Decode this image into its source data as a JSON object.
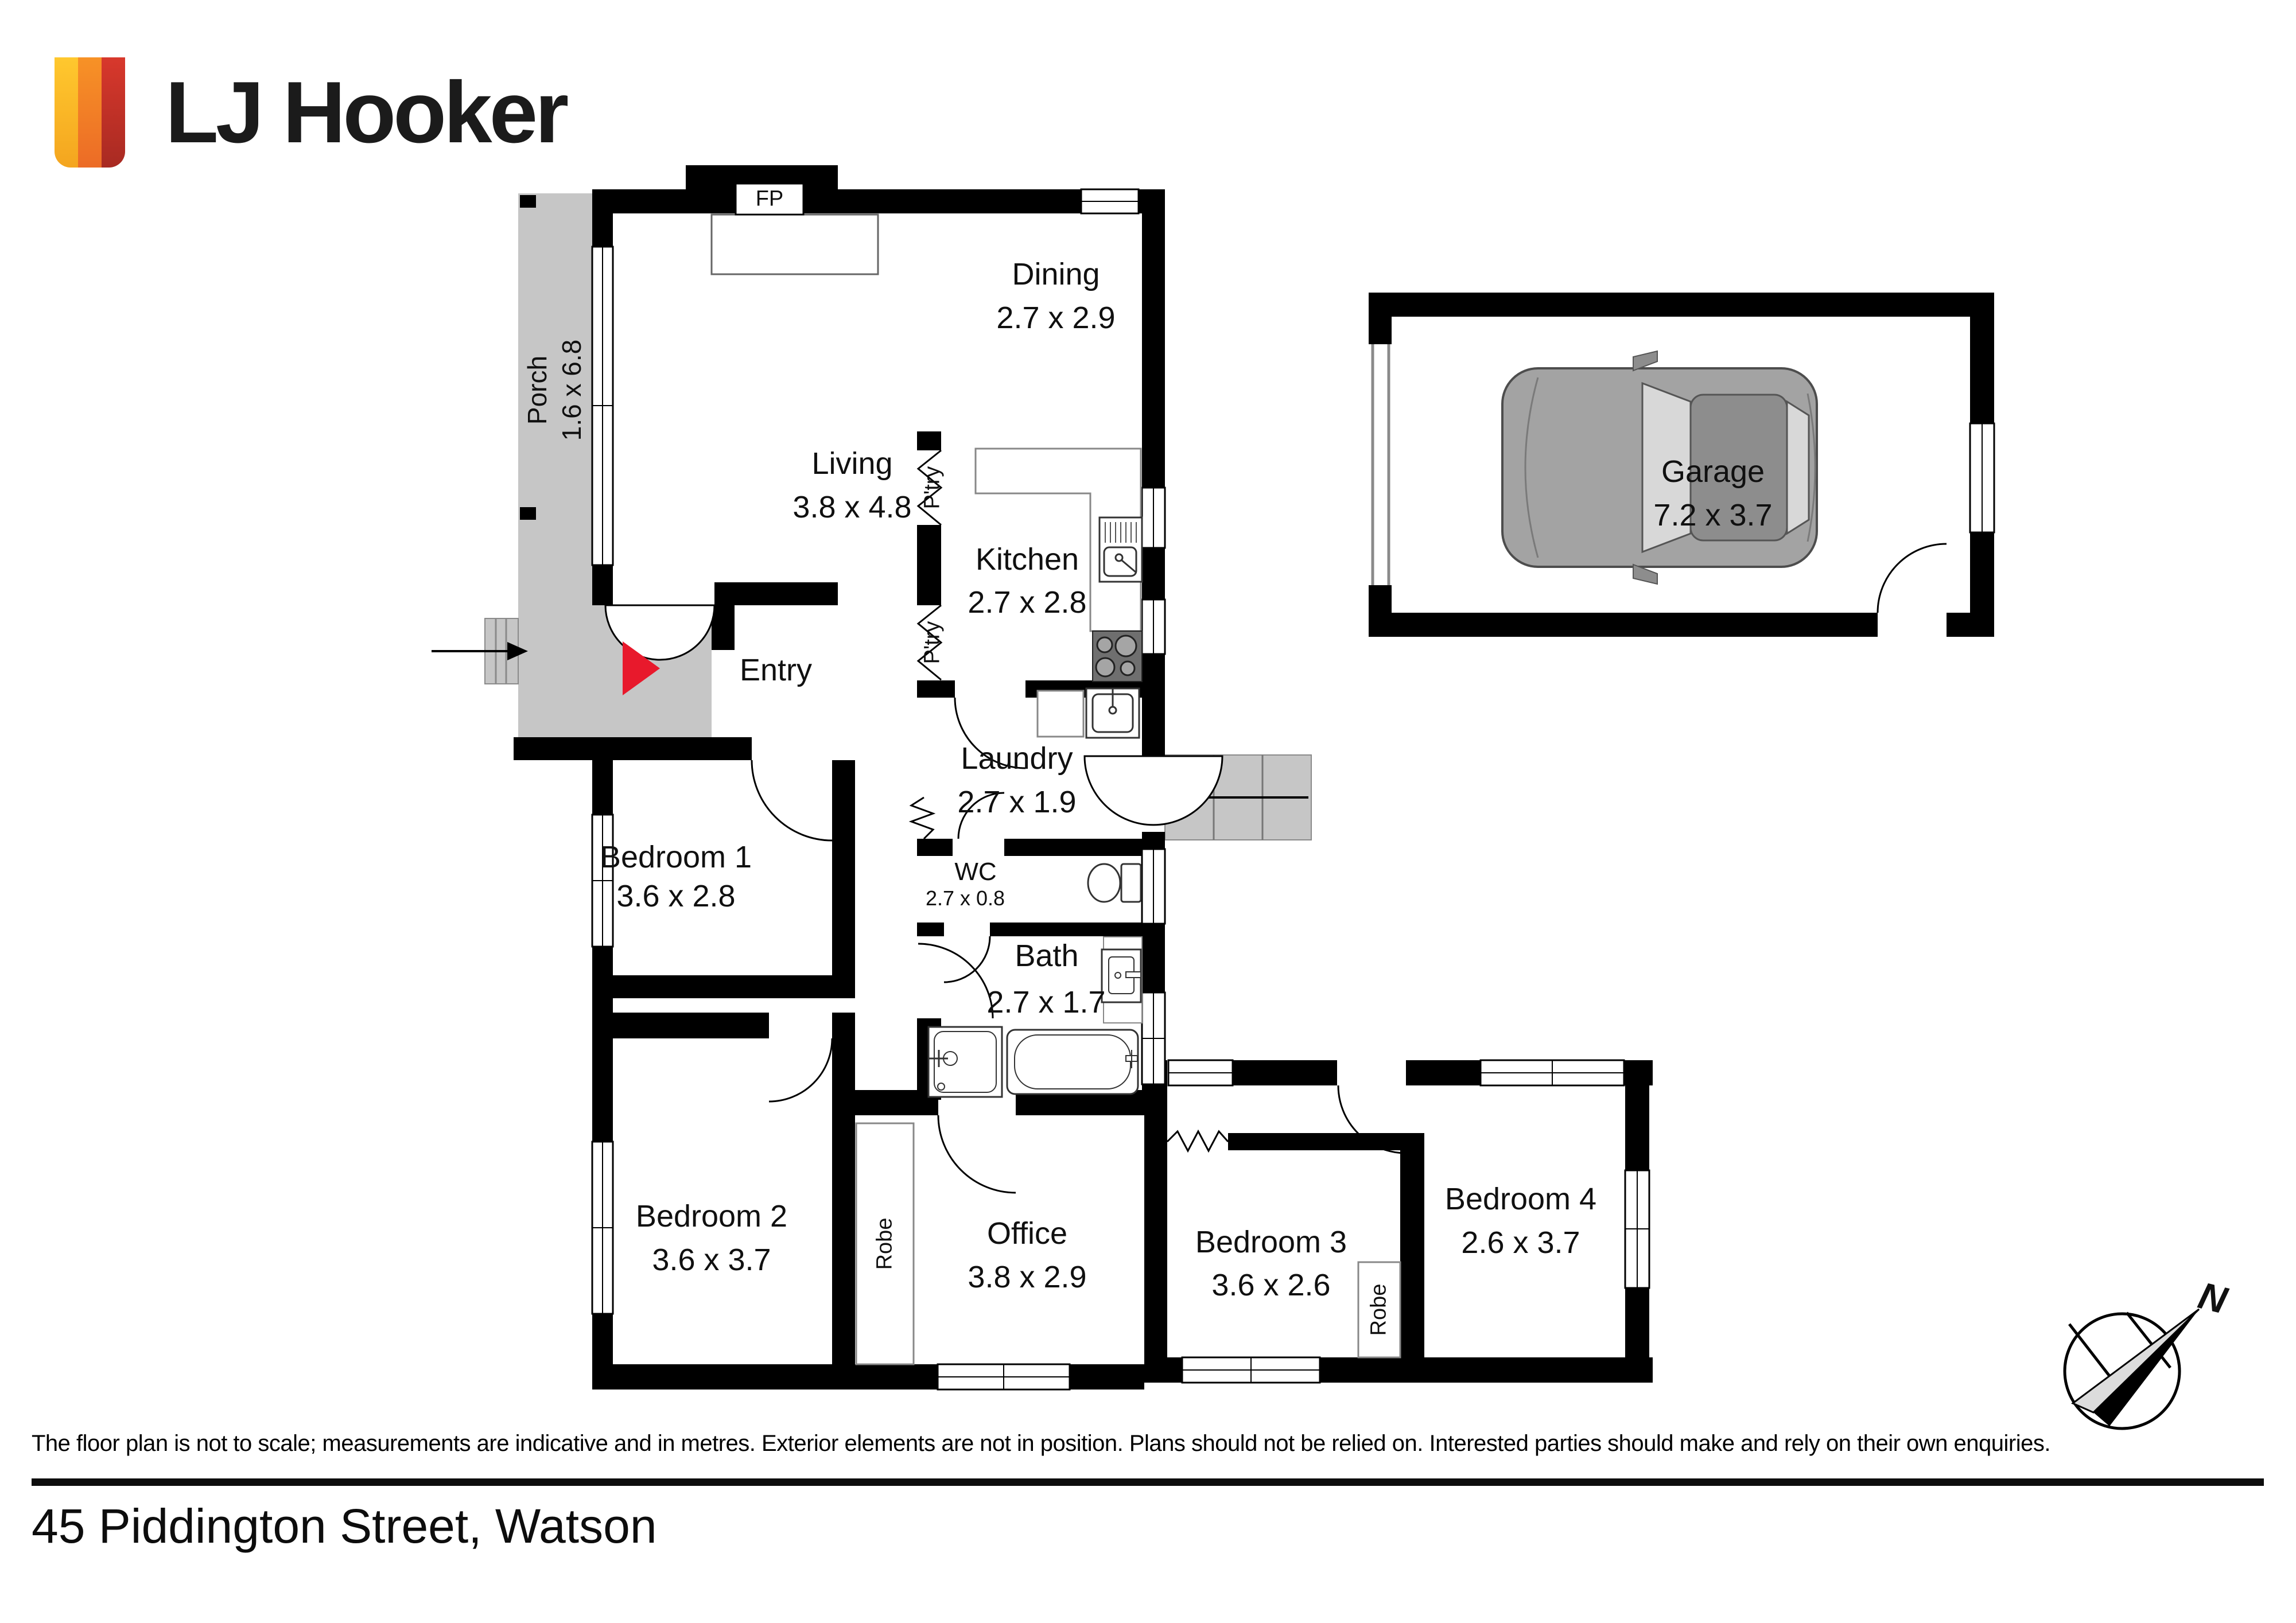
{
  "brand": {
    "logo_text": "LJ Hooker"
  },
  "rooms": [
    {
      "name": "Living",
      "dims": "3.8 x 4.8"
    },
    {
      "name": "Dining",
      "dims": "2.7 x 2.9"
    },
    {
      "name": "Kitchen",
      "dims": "2.7 x 2.8"
    },
    {
      "name": "Laundry",
      "dims": "2.7 x 1.9"
    },
    {
      "name": "Entry",
      "dims": ""
    },
    {
      "name": "WC",
      "dims": "2.7 x 0.8"
    },
    {
      "name": "Bath",
      "dims": "2.7 x 1.7"
    },
    {
      "name": "Bedroom 1",
      "dims": "3.6 x 2.8"
    },
    {
      "name": "Bedroom 2",
      "dims": "3.6 x 3.7"
    },
    {
      "name": "Office",
      "dims": "3.8 x 2.9"
    },
    {
      "name": "Bedroom 3",
      "dims": "3.6 x 2.6"
    },
    {
      "name": "Bedroom 4",
      "dims": "2.6 x 3.7"
    },
    {
      "name": "Garage",
      "dims": "7.2 x 3.7"
    },
    {
      "name": "Porch",
      "dims": "1.6 x 6.8"
    }
  ],
  "annotations": {
    "fireplace": "FP",
    "pantry": "P'try",
    "robe": "Robe",
    "north": "N"
  },
  "footer": {
    "disclaimer": "The floor plan is not to scale; measurements are indicative and in metres. Exterior elements are not in position. Plans should not be relied on. Interested parties should make and rely on their own enquiries.",
    "address": "45 Piddington Street, Watson"
  }
}
